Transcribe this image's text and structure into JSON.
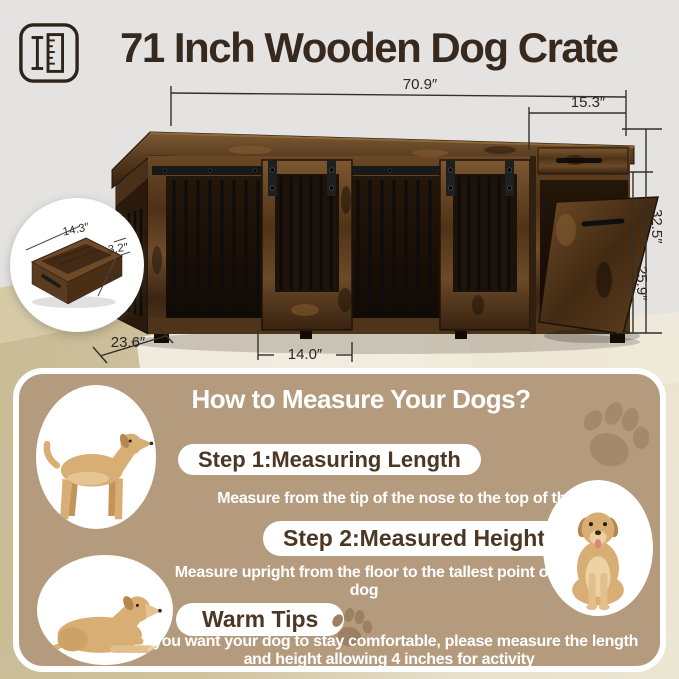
{
  "header": {
    "title": "71 Inch Wooden Dog Crate",
    "icon": "ruler-measure-icon"
  },
  "dimensions": {
    "total_width": "70.9″",
    "side_section_width": "15.3″",
    "total_height": "32.5″",
    "door_opening_height": "25.9″",
    "depth": "23.6″",
    "door_width": "14.0″",
    "drawer_width": "14.3″",
    "drawer_height": "3.2″",
    "drawer_depth": "19″"
  },
  "measure_guide": {
    "title": "How to Measure Your Dogs?",
    "steps": [
      {
        "label": "Step 1:Measuring Length",
        "description": "Measure from the tip of the nose to the top of their tail"
      },
      {
        "label": "Step 2:Measured Height",
        "description": "Measure upright from the floor to the tallest point of dog"
      },
      {
        "label": "Warm Tips",
        "description": "If you want your dog to stay comfortable, please measure the length and height allowing 4 inches for activity"
      }
    ]
  },
  "colors": {
    "page_background": "#e4e3e1",
    "guide_background": "#b59b7d",
    "title_text": "#38291e",
    "paw_print": "#a48a6c",
    "wood_dark": "#3c2613",
    "wood_mid": "#6b4826"
  }
}
